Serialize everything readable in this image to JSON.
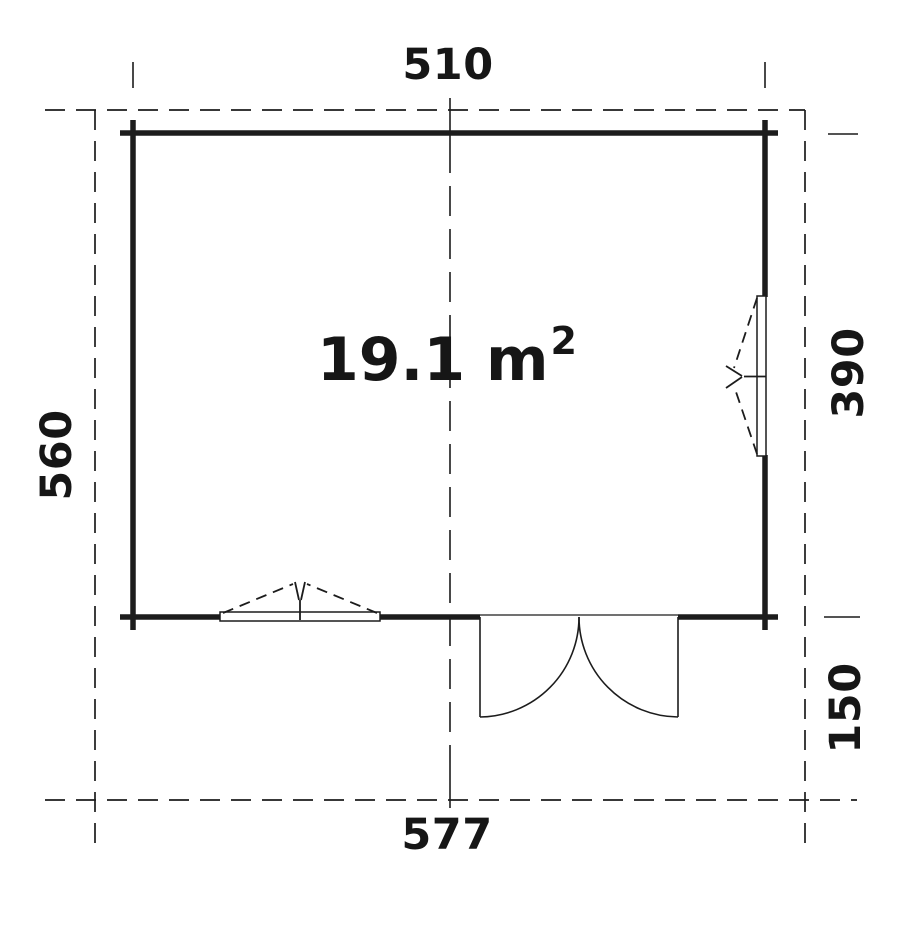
{
  "plan": {
    "area_label": {
      "value": "19.1 m",
      "exponent": "2"
    },
    "dimensions": {
      "top_width": "510",
      "left_depth": "560",
      "right_wall_depth": "390",
      "right_canopy_depth": "150",
      "bottom_width": "577"
    },
    "colors": {
      "line": "#1c1c1c",
      "background": "#ffffff"
    }
  }
}
